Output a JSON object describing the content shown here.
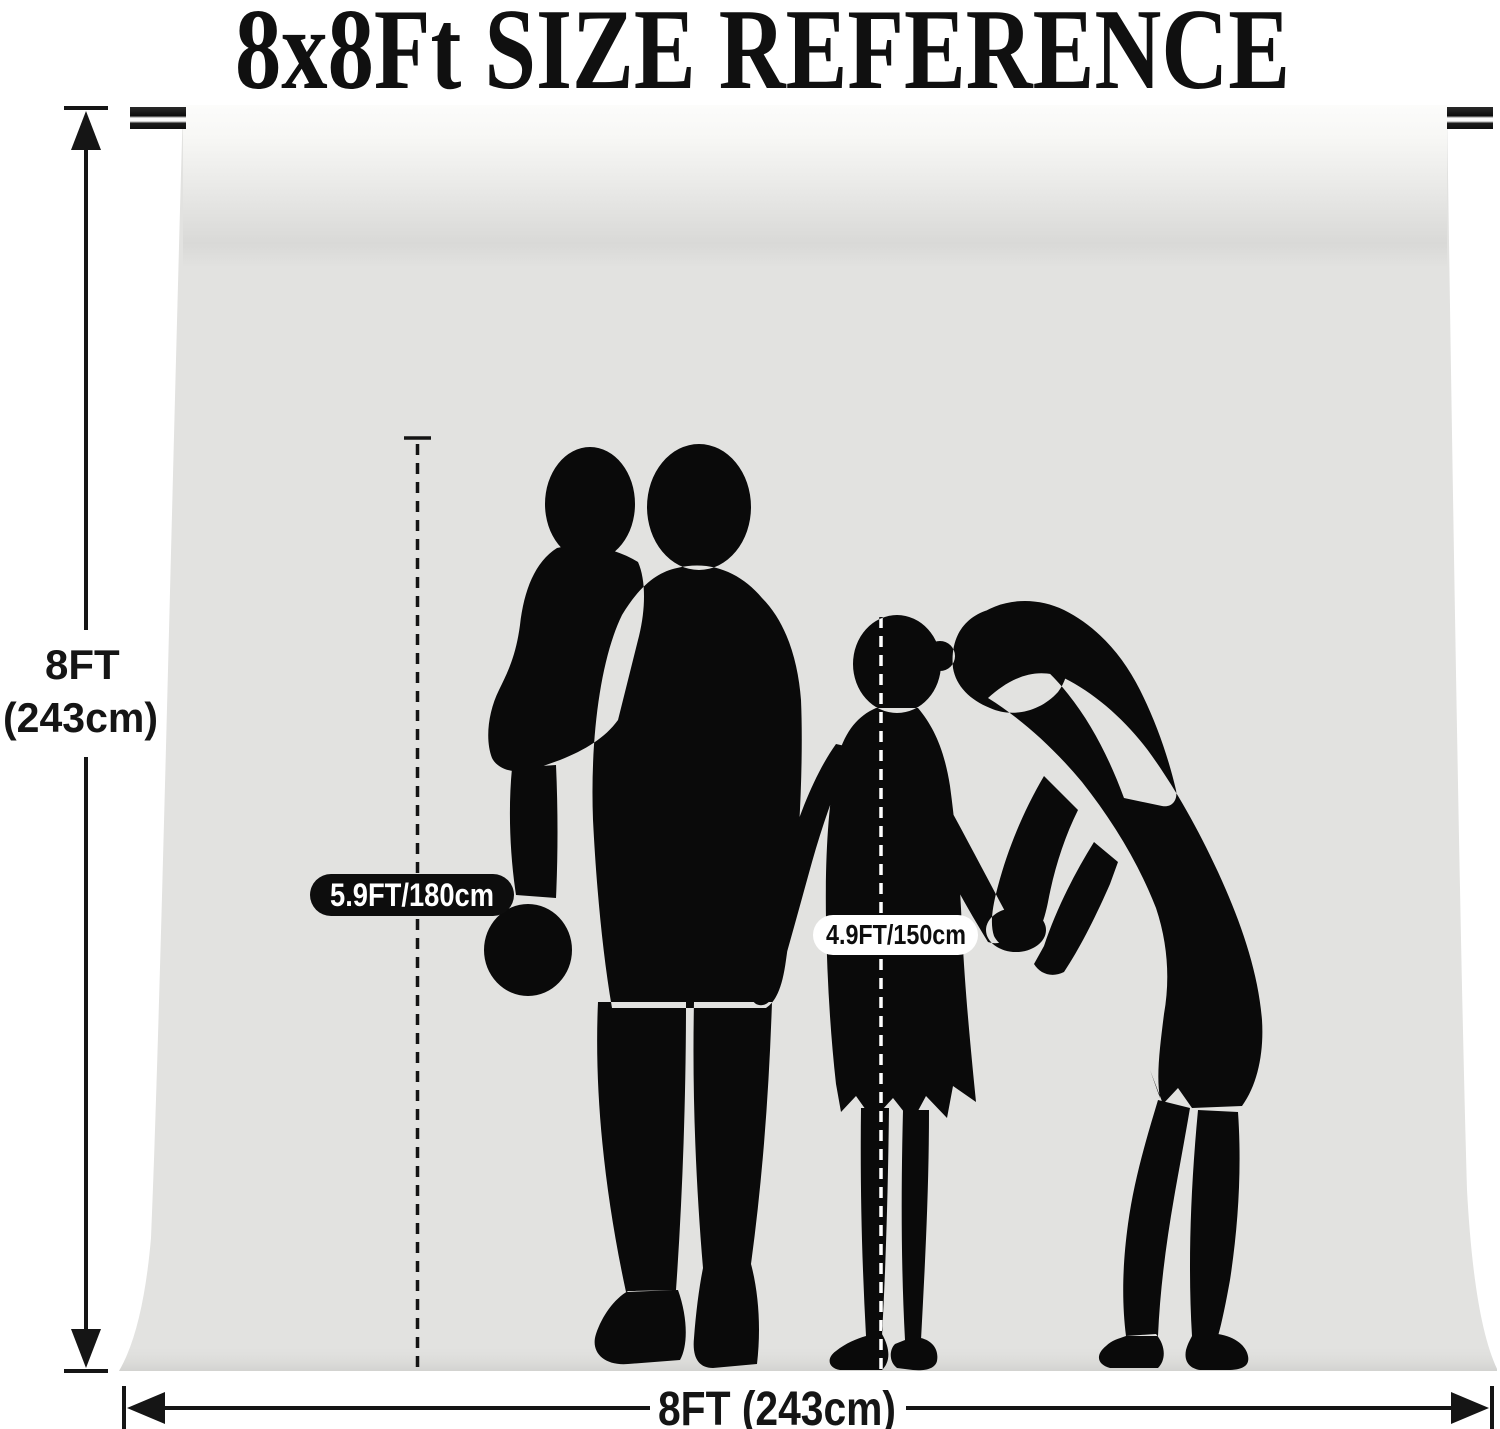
{
  "title": "8x8Ft SIZE REFERENCE",
  "dimensions": {
    "height": {
      "line1": "8FT",
      "line2": "(243cm)"
    },
    "width": {
      "label": "8FT (243cm)"
    }
  },
  "height_markers": {
    "adult": "5.9FT/180cm",
    "child": "4.9FT/150cm"
  },
  "colors": {
    "page_background": "#ffffff",
    "backdrop_gray": "#e2e2e0",
    "backdrop_roll_highlight": "#fcfcfb",
    "silhouette_black": "#0a0a0a",
    "line_color": "#141414",
    "adult_badge_background": "#0d0d0d",
    "adult_badge_text": "#ffffff",
    "child_badge_background": "#ffffff",
    "child_badge_text": "#0d0d0d"
  }
}
